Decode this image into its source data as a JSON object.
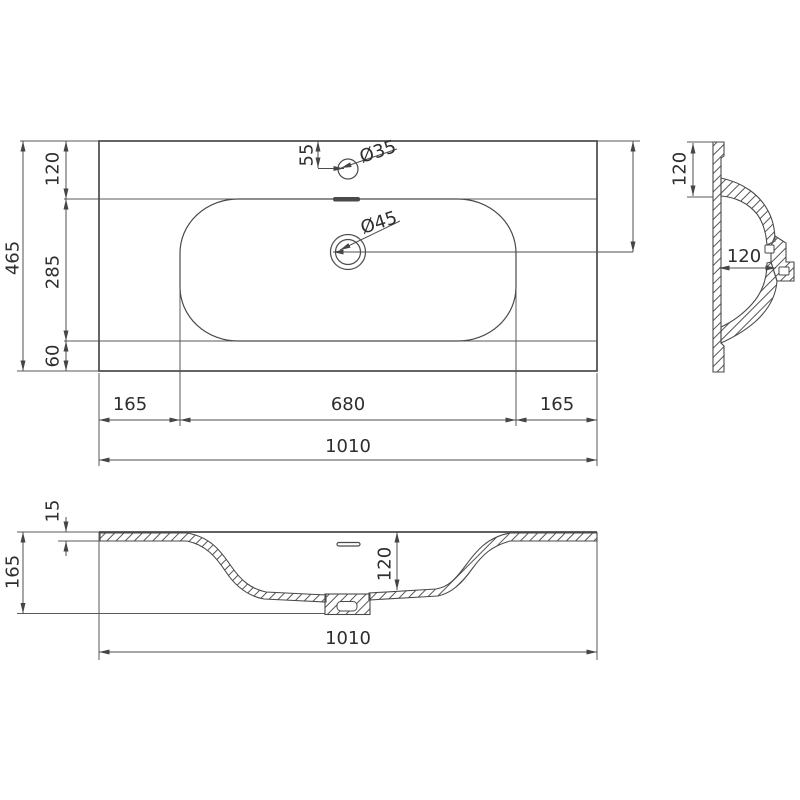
{
  "views": {
    "plan": {
      "dims": {
        "overall_depth": "465",
        "back_edge_to_rim": "120",
        "rim_depth": "285",
        "rim_to_front_edge": "60",
        "faucet_offset": "55",
        "faucet_hole_diameter": "Ø35",
        "drain_hole_diameter": "Ø45",
        "back_edge_to_drain": "225",
        "rim_margin_left": "165",
        "rim_width": "680",
        "rim_margin_right": "165",
        "overall_width": "1010"
      }
    },
    "side": {
      "dims": {
        "top_to_basin": "120",
        "back_to_drain_boss": "120"
      }
    },
    "front": {
      "dims": {
        "flange_thickness": "15",
        "overall_height": "165",
        "basin_depth": "120",
        "overall_width": "1010"
      }
    }
  }
}
